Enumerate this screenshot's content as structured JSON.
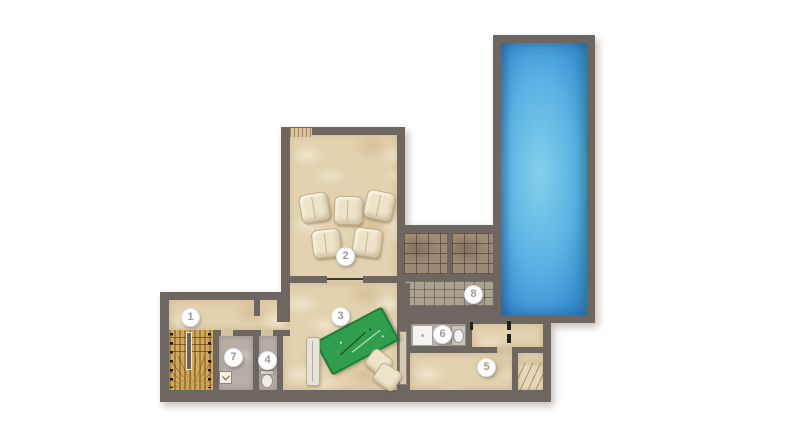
{
  "markers": [
    {
      "number": "1"
    },
    {
      "number": "2"
    },
    {
      "number": "3"
    },
    {
      "number": "4"
    },
    {
      "number": "5"
    },
    {
      "number": "6"
    },
    {
      "number": "7"
    },
    {
      "number": "8"
    }
  ],
  "colors": {
    "wall": "#6e6761",
    "floor_beige": "#e3d2af",
    "floor_gray": "#b7aea6",
    "stairs_wood": "#c0964a",
    "terrace_tile": "#9c8a77",
    "terrace_tile_lower": "#aba294",
    "pool_water_light": "#85cfec",
    "pool_water_dark": "#2b74ba",
    "table_green": "#2f9e4d",
    "cushion": "#ede3c9"
  }
}
